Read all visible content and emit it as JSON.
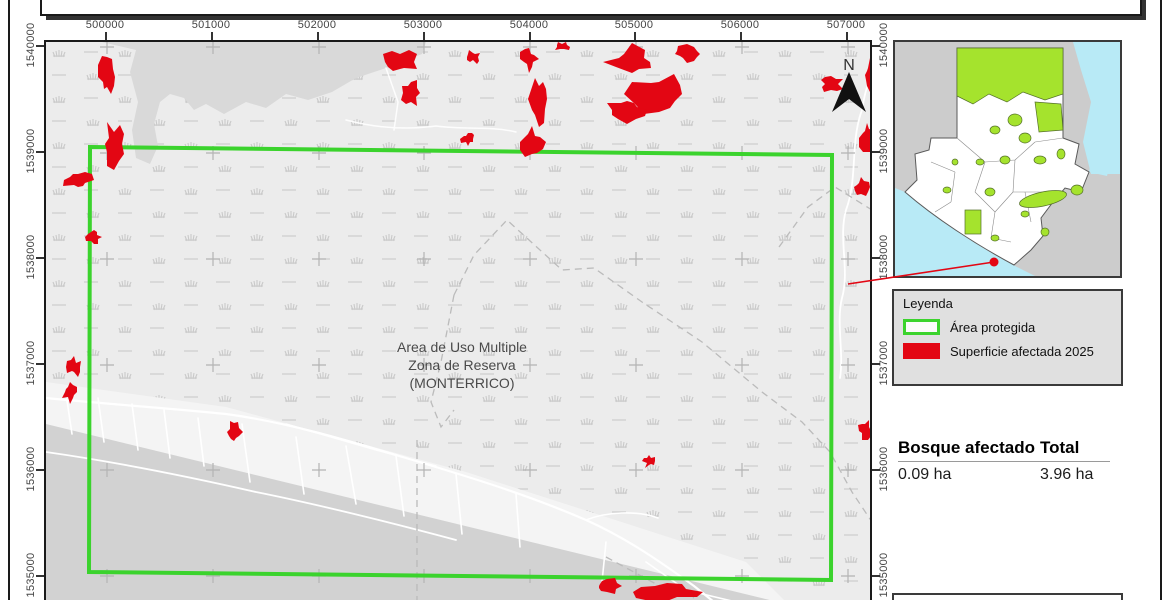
{
  "map": {
    "north": "N",
    "area_label": {
      "line1": "Area de Uso Multiple",
      "line2": "Zona de Reserva",
      "line3": "(MONTERRICO)"
    },
    "x_axis": [
      "500000",
      "501000",
      "502000",
      "503000",
      "504000",
      "505000",
      "506000",
      "507000"
    ],
    "y_axis": [
      "1540000",
      "1539000",
      "1538000",
      "1537000",
      "1536000",
      "1535000"
    ]
  },
  "legend": {
    "title": "Leyenda",
    "items": [
      {
        "label": "Área protegida",
        "swatch": "green-outline"
      },
      {
        "label": "Superficie afectada 2025",
        "swatch": "red-fill"
      }
    ]
  },
  "stats": {
    "columns": [
      {
        "header": "Bosque afectado",
        "value": "0.09 ha"
      },
      {
        "header": "Total",
        "value": "3.96 ha"
      }
    ]
  },
  "colors": {
    "protected": "#3bd32d",
    "affected": "#e30613",
    "inset_green": "#a5e32d",
    "water": "#b8eaf6",
    "neighbor": "#cccccc",
    "land": "#ececec",
    "ocean": "#d2d2d2",
    "waterbody": "#d9d9d9",
    "beach": "#f4f4f4",
    "pattern": "#c7c7c7"
  }
}
